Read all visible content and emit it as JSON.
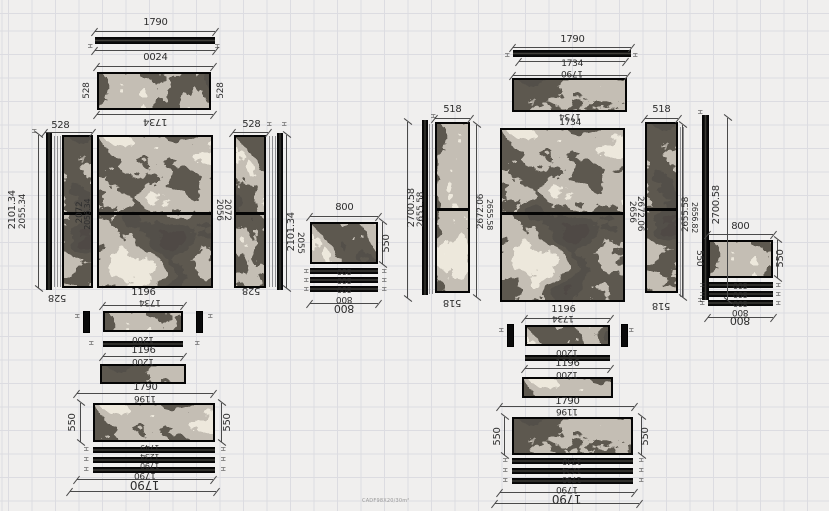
{
  "caption": "CADF98X20/30m²",
  "colors": {
    "background": "#f0efee",
    "grid_line": "#dcdce1",
    "dimension": "#4a4a4a",
    "dimension_text": "#2e2e2e",
    "panel_frame": "#050505",
    "marble_base": "#17130d",
    "marble_vein": "#d6cfc0"
  },
  "panels": [
    {
      "name": "left-top-528-panel",
      "x": 97,
      "y": 72,
      "w": 114,
      "h": 38,
      "tex": "B",
      "split": null
    },
    {
      "name": "left-side-panel-a",
      "x": 62,
      "y": 135,
      "w": 31,
      "h": 153,
      "tex": "C",
      "split": 0.5
    },
    {
      "name": "left-main-panel",
      "x": 97,
      "y": 135,
      "w": 116,
      "h": 153,
      "tex": "A",
      "split": 0.5
    },
    {
      "name": "left-side-panel-b",
      "x": 234,
      "y": 135,
      "w": 32,
      "h": 153,
      "tex": "D",
      "split": 0.5
    },
    {
      "name": "left-800-panel",
      "x": 310,
      "y": 222,
      "w": 68,
      "h": 42,
      "tex": "D",
      "split": null
    },
    {
      "name": "left-band-strip-a",
      "x": 103,
      "y": 311,
      "w": 80,
      "h": 21,
      "tex": "B",
      "split": null
    },
    {
      "name": "left-band-strip-b",
      "x": 100,
      "y": 364,
      "w": 86,
      "h": 20,
      "tex": "C",
      "split": null
    },
    {
      "name": "left-bottom-band",
      "x": 93,
      "y": 403,
      "w": 122,
      "h": 39,
      "tex": "A",
      "split": null
    },
    {
      "name": "right-top-518-panel",
      "x": 512,
      "y": 78,
      "w": 115,
      "h": 34,
      "tex": "C",
      "split": null
    },
    {
      "name": "right-side-panel-a",
      "x": 435,
      "y": 122,
      "w": 35,
      "h": 171,
      "tex": "B",
      "split": 0.5
    },
    {
      "name": "right-main-panel",
      "x": 500,
      "y": 128,
      "w": 125,
      "h": 174,
      "tex": "A",
      "split": 0.48
    },
    {
      "name": "right-side-panel-b",
      "x": 645,
      "y": 122,
      "w": 33,
      "h": 171,
      "tex": "C",
      "split": 0.5
    },
    {
      "name": "right-800-panel",
      "x": 708,
      "y": 240,
      "w": 65,
      "h": 38,
      "tex": "B",
      "split": null
    },
    {
      "name": "right-band-strip-a",
      "x": 525,
      "y": 325,
      "w": 85,
      "h": 21,
      "tex": "D",
      "split": null
    },
    {
      "name": "right-band-strip-b",
      "x": 522,
      "y": 377,
      "w": 91,
      "h": 21,
      "tex": "A",
      "split": null
    },
    {
      "name": "right-bottom-band",
      "x": 512,
      "y": 417,
      "w": 121,
      "h": 38,
      "tex": "C",
      "split": null
    }
  ],
  "edge_strips_h": [
    {
      "x": 95,
      "y": 37,
      "w": 120,
      "h": 7
    },
    {
      "x": 103,
      "y": 341,
      "w": 80,
      "h": 6
    },
    {
      "x": 93,
      "y": 447,
      "w": 122,
      "h": 6
    },
    {
      "x": 93,
      "y": 457,
      "w": 122,
      "h": 6
    },
    {
      "x": 93,
      "y": 467,
      "w": 122,
      "h": 6
    },
    {
      "x": 310,
      "y": 268,
      "w": 68,
      "h": 6
    },
    {
      "x": 310,
      "y": 277,
      "w": 68,
      "h": 6
    },
    {
      "x": 310,
      "y": 286,
      "w": 68,
      "h": 6
    },
    {
      "x": 513,
      "y": 50,
      "w": 118,
      "h": 7
    },
    {
      "x": 525,
      "y": 355,
      "w": 85,
      "h": 6
    },
    {
      "x": 512,
      "y": 458,
      "w": 121,
      "h": 6
    },
    {
      "x": 512,
      "y": 468,
      "w": 121,
      "h": 6
    },
    {
      "x": 512,
      "y": 478,
      "w": 121,
      "h": 6
    },
    {
      "x": 708,
      "y": 282,
      "w": 65,
      "h": 6
    },
    {
      "x": 708,
      "y": 291,
      "w": 65,
      "h": 6
    },
    {
      "x": 708,
      "y": 300,
      "w": 65,
      "h": 6
    }
  ],
  "edge_strips_v": [
    {
      "x": 46,
      "y": 133,
      "w": 6,
      "h": 157
    },
    {
      "x": 277,
      "y": 133,
      "w": 6,
      "h": 157
    },
    {
      "x": 422,
      "y": 120,
      "w": 6,
      "h": 175
    },
    {
      "x": 702,
      "y": 115,
      "w": 7,
      "h": 185
    }
  ],
  "hatch_lines": [
    {
      "x": 54,
      "y": 136,
      "w": 8,
      "h": 151
    },
    {
      "x": 269,
      "y": 136,
      "w": 7,
      "h": 151
    },
    {
      "x": 429,
      "y": 124,
      "w": 6,
      "h": 170
    },
    {
      "x": 680,
      "y": 127,
      "w": 5,
      "h": 170
    }
  ],
  "posts": [
    {
      "x": 83,
      "y": 311,
      "w": 7,
      "h": 22
    },
    {
      "x": 196,
      "y": 311,
      "w": 7,
      "h": 22
    },
    {
      "x": 507,
      "y": 324,
      "w": 7,
      "h": 23
    },
    {
      "x": 621,
      "y": 324,
      "w": 7,
      "h": 23
    }
  ],
  "dim_lines": [
    {
      "o": "h",
      "x": 95,
      "y": 31,
      "l": 120
    },
    {
      "o": "h",
      "x": 95,
      "y": 50,
      "l": 120
    },
    {
      "o": "h",
      "x": 97,
      "y": 66,
      "l": 116
    },
    {
      "o": "h",
      "x": 97,
      "y": 114,
      "l": 116
    },
    {
      "o": "h",
      "x": 45,
      "y": 132,
      "l": 47
    },
    {
      "o": "h",
      "x": 233,
      "y": 132,
      "l": 35
    },
    {
      "o": "v",
      "x": 38,
      "y": 135,
      "l": 153
    },
    {
      "o": "v",
      "x": 286,
      "y": 135,
      "l": 153
    },
    {
      "o": "h",
      "x": 310,
      "y": 216,
      "l": 68
    },
    {
      "o": "v",
      "x": 382,
      "y": 222,
      "l": 42
    },
    {
      "o": "h",
      "x": 310,
      "y": 303,
      "l": 68
    },
    {
      "o": "h",
      "x": 103,
      "y": 305,
      "l": 80
    },
    {
      "o": "h",
      "x": 103,
      "y": 356,
      "l": 80
    },
    {
      "o": "h",
      "x": 77,
      "y": 393,
      "l": 136
    },
    {
      "o": "v",
      "x": 80,
      "y": 403,
      "l": 39
    },
    {
      "o": "v",
      "x": 221,
      "y": 403,
      "l": 39
    },
    {
      "o": "h",
      "x": 77,
      "y": 479,
      "l": 136
    },
    {
      "o": "h",
      "x": 70,
      "y": 491,
      "l": 146
    },
    {
      "o": "h",
      "x": 513,
      "y": 47,
      "l": 118
    },
    {
      "o": "h",
      "x": 519,
      "y": 61,
      "l": 106
    },
    {
      "o": "h",
      "x": 513,
      "y": 75,
      "l": 114
    },
    {
      "o": "h",
      "x": 435,
      "y": 118,
      "l": 35
    },
    {
      "o": "h",
      "x": 645,
      "y": 118,
      "l": 33
    },
    {
      "o": "v",
      "x": 407,
      "y": 122,
      "l": 176
    },
    {
      "o": "v",
      "x": 476,
      "y": 125,
      "l": 172
    },
    {
      "o": "v",
      "x": 682,
      "y": 125,
      "l": 172
    },
    {
      "o": "v",
      "x": 727,
      "y": 118,
      "l": 182
    },
    {
      "o": "h",
      "x": 708,
      "y": 234,
      "l": 65
    },
    {
      "o": "v",
      "x": 777,
      "y": 240,
      "l": 38
    },
    {
      "o": "h",
      "x": 708,
      "y": 317,
      "l": 65
    },
    {
      "o": "h",
      "x": 525,
      "y": 318,
      "l": 85
    },
    {
      "o": "h",
      "x": 525,
      "y": 368,
      "l": 85
    },
    {
      "o": "h",
      "x": 500,
      "y": 406,
      "l": 134
    },
    {
      "o": "v",
      "x": 504,
      "y": 417,
      "l": 38
    },
    {
      "o": "v",
      "x": 641,
      "y": 417,
      "l": 38
    },
    {
      "o": "h",
      "x": 500,
      "y": 492,
      "l": 134
    },
    {
      "o": "h",
      "x": 495,
      "y": 503,
      "l": 144
    }
  ],
  "labels": [
    {
      "t": "1790",
      "x": 155,
      "y": 23,
      "s": 10,
      "o": ""
    },
    {
      "t": "0024",
      "x": 155,
      "y": 58,
      "s": 10,
      "o": ""
    },
    {
      "t": "528",
      "x": 87,
      "y": 90,
      "s": 9,
      "o": "v"
    },
    {
      "t": "528",
      "x": 221,
      "y": 90,
      "s": 9,
      "o": "v"
    },
    {
      "t": "1734",
      "x": 155,
      "y": 121,
      "s": 10,
      "o": "f"
    },
    {
      "t": "528",
      "x": 60,
      "y": 126,
      "s": 10,
      "o": ""
    },
    {
      "t": "528",
      "x": 251,
      "y": 125,
      "s": 10,
      "o": ""
    },
    {
      "t": "2101.34",
      "x": 13,
      "y": 210,
      "s": 10,
      "o": "v"
    },
    {
      "t": "2055.34",
      "x": 23,
      "y": 212,
      "s": 9,
      "o": "v"
    },
    {
      "t": "2072",
      "x": 80,
      "y": 212,
      "s": 9,
      "o": "v"
    },
    {
      "t": "2056.34",
      "x": 88,
      "y": 214,
      "s": 8,
      "o": "v"
    },
    {
      "t": "2056",
      "x": 218,
      "y": 210,
      "s": 9,
      "o": "vf"
    },
    {
      "t": "2072",
      "x": 226,
      "y": 210,
      "s": 9,
      "o": "vf"
    },
    {
      "t": "2101.34",
      "x": 292,
      "y": 232,
      "s": 10,
      "o": "v"
    },
    {
      "t": "2055",
      "x": 299,
      "y": 243,
      "s": 9,
      "o": "vf"
    },
    {
      "t": "528",
      "x": 57,
      "y": 297,
      "s": 10,
      "o": "f"
    },
    {
      "t": "528",
      "x": 251,
      "y": 290,
      "s": 10,
      "o": "f"
    },
    {
      "t": "800",
      "x": 344,
      "y": 208,
      "s": 10,
      "o": ""
    },
    {
      "t": "550",
      "x": 387,
      "y": 243,
      "s": 10,
      "o": "v"
    },
    {
      "t": "800",
      "x": 344,
      "y": 271,
      "s": 8,
      "o": "f"
    },
    {
      "t": "800",
      "x": 344,
      "y": 280,
      "s": 8,
      "o": "f"
    },
    {
      "t": "800",
      "x": 344,
      "y": 289,
      "s": 8,
      "o": "f"
    },
    {
      "t": "800",
      "x": 344,
      "y": 298,
      "s": 9,
      "o": "f"
    },
    {
      "t": "800",
      "x": 344,
      "y": 308,
      "s": 11,
      "o": "f"
    },
    {
      "t": "1196",
      "x": 143,
      "y": 293,
      "s": 10,
      "o": ""
    },
    {
      "t": "1734",
      "x": 150,
      "y": 301,
      "s": 9,
      "o": "f"
    },
    {
      "t": "1200",
      "x": 143,
      "y": 338,
      "s": 9,
      "o": "f"
    },
    {
      "t": "1196",
      "x": 143,
      "y": 351,
      "s": 10,
      "o": ""
    },
    {
      "t": "1200",
      "x": 143,
      "y": 360,
      "s": 9,
      "o": "f"
    },
    {
      "t": "1790",
      "x": 145,
      "y": 388,
      "s": 10,
      "o": ""
    },
    {
      "t": "1196",
      "x": 145,
      "y": 397,
      "s": 9,
      "o": "f"
    },
    {
      "t": "550",
      "x": 73,
      "y": 422,
      "s": 10,
      "o": "v"
    },
    {
      "t": "550",
      "x": 228,
      "y": 422,
      "s": 10,
      "o": "v"
    },
    {
      "t": "1749",
      "x": 150,
      "y": 447,
      "s": 8,
      "o": "f"
    },
    {
      "t": "1234",
      "x": 150,
      "y": 456,
      "s": 8,
      "o": "f"
    },
    {
      "t": "1790",
      "x": 150,
      "y": 465,
      "s": 8,
      "o": "f"
    },
    {
      "t": "1790",
      "x": 145,
      "y": 474,
      "s": 9,
      "o": "f"
    },
    {
      "t": "1790",
      "x": 145,
      "y": 485,
      "s": 12,
      "o": "f"
    },
    {
      "t": "1790",
      "x": 572,
      "y": 40,
      "s": 10,
      "o": ""
    },
    {
      "t": "1734",
      "x": 572,
      "y": 64,
      "s": 9,
      "o": ""
    },
    {
      "t": "1790",
      "x": 572,
      "y": 72,
      "s": 9,
      "o": "f"
    },
    {
      "t": "1734",
      "x": 570,
      "y": 115,
      "s": 9,
      "o": "f"
    },
    {
      "t": "1734",
      "x": 570,
      "y": 123,
      "s": 9,
      "o": ""
    },
    {
      "t": "518",
      "x": 452,
      "y": 110,
      "s": 10,
      "o": ""
    },
    {
      "t": "518",
      "x": 661,
      "y": 110,
      "s": 10,
      "o": ""
    },
    {
      "t": "2700.58",
      "x": 412,
      "y": 208,
      "s": 10,
      "o": "v"
    },
    {
      "t": "2655.58",
      "x": 421,
      "y": 210,
      "s": 9,
      "o": "v"
    },
    {
      "t": "2672.06",
      "x": 481,
      "y": 212,
      "s": 9,
      "o": "v"
    },
    {
      "t": "2655.58",
      "x": 489,
      "y": 214,
      "s": 8,
      "o": "vf"
    },
    {
      "t": "2656",
      "x": 631,
      "y": 212,
      "s": 9,
      "o": "vf"
    },
    {
      "t": "2672.06",
      "x": 639,
      "y": 214,
      "s": 9,
      "o": "vf"
    },
    {
      "t": "2655.58",
      "x": 686,
      "y": 215,
      "s": 9,
      "o": "v"
    },
    {
      "t": "2656.82",
      "x": 694,
      "y": 217,
      "s": 8,
      "o": "vf"
    },
    {
      "t": "518",
      "x": 452,
      "y": 302,
      "s": 10,
      "o": "f"
    },
    {
      "t": "518",
      "x": 661,
      "y": 305,
      "s": 10,
      "o": "f"
    },
    {
      "t": "2700.58",
      "x": 717,
      "y": 205,
      "s": 10,
      "o": "v"
    },
    {
      "t": "550",
      "x": 698,
      "y": 258,
      "s": 9,
      "o": "vf"
    },
    {
      "t": "800",
      "x": 740,
      "y": 227,
      "s": 10,
      "o": ""
    },
    {
      "t": "550",
      "x": 781,
      "y": 258,
      "s": 10,
      "o": "v"
    },
    {
      "t": "800",
      "x": 740,
      "y": 285,
      "s": 8,
      "o": "f"
    },
    {
      "t": "800",
      "x": 740,
      "y": 294,
      "s": 8,
      "o": "f"
    },
    {
      "t": "800",
      "x": 740,
      "y": 303,
      "s": 8,
      "o": "f"
    },
    {
      "t": "800",
      "x": 740,
      "y": 311,
      "s": 9,
      "o": "f"
    },
    {
      "t": "800",
      "x": 740,
      "y": 320,
      "s": 11,
      "o": "f"
    },
    {
      "t": "1196",
      "x": 563,
      "y": 310,
      "s": 10,
      "o": ""
    },
    {
      "t": "1734",
      "x": 563,
      "y": 317,
      "s": 9,
      "o": "f"
    },
    {
      "t": "1200",
      "x": 567,
      "y": 351,
      "s": 9,
      "o": "f"
    },
    {
      "t": "1196",
      "x": 567,
      "y": 364,
      "s": 10,
      "o": ""
    },
    {
      "t": "1200",
      "x": 567,
      "y": 373,
      "s": 9,
      "o": "f"
    },
    {
      "t": "1790",
      "x": 567,
      "y": 402,
      "s": 10,
      "o": ""
    },
    {
      "t": "1196",
      "x": 567,
      "y": 410,
      "s": 9,
      "o": "f"
    },
    {
      "t": "550",
      "x": 498,
      "y": 436,
      "s": 10,
      "o": "v"
    },
    {
      "t": "550",
      "x": 646,
      "y": 436,
      "s": 10,
      "o": "v"
    },
    {
      "t": "1749",
      "x": 572,
      "y": 461,
      "s": 8,
      "o": "f"
    },
    {
      "t": "1234",
      "x": 572,
      "y": 470,
      "s": 8,
      "o": "f"
    },
    {
      "t": "1790",
      "x": 572,
      "y": 479,
      "s": 8,
      "o": "f"
    },
    {
      "t": "1790",
      "x": 567,
      "y": 488,
      "s": 9,
      "o": "f"
    },
    {
      "t": "1790",
      "x": 567,
      "y": 499,
      "s": 12,
      "o": "f"
    }
  ],
  "tick_marks": [
    {
      "x": 89,
      "y": 46
    },
    {
      "x": 216,
      "y": 46
    },
    {
      "x": 33,
      "y": 131
    },
    {
      "x": 268,
      "y": 124
    },
    {
      "x": 283,
      "y": 124
    },
    {
      "x": 76,
      "y": 316
    },
    {
      "x": 209,
      "y": 316
    },
    {
      "x": 90,
      "y": 343
    },
    {
      "x": 196,
      "y": 343
    },
    {
      "x": 85,
      "y": 449
    },
    {
      "x": 222,
      "y": 449
    },
    {
      "x": 85,
      "y": 459
    },
    {
      "x": 222,
      "y": 459
    },
    {
      "x": 85,
      "y": 469
    },
    {
      "x": 222,
      "y": 469
    },
    {
      "x": 305,
      "y": 271
    },
    {
      "x": 383,
      "y": 271
    },
    {
      "x": 305,
      "y": 280
    },
    {
      "x": 383,
      "y": 280
    },
    {
      "x": 305,
      "y": 289
    },
    {
      "x": 383,
      "y": 289
    },
    {
      "x": 506,
      "y": 55
    },
    {
      "x": 634,
      "y": 55
    },
    {
      "x": 432,
      "y": 116
    },
    {
      "x": 699,
      "y": 112
    },
    {
      "x": 699,
      "y": 300
    },
    {
      "x": 500,
      "y": 330
    },
    {
      "x": 630,
      "y": 330
    },
    {
      "x": 701,
      "y": 285
    },
    {
      "x": 777,
      "y": 285
    },
    {
      "x": 701,
      "y": 294
    },
    {
      "x": 777,
      "y": 294
    },
    {
      "x": 701,
      "y": 303
    },
    {
      "x": 777,
      "y": 303
    },
    {
      "x": 504,
      "y": 460
    },
    {
      "x": 640,
      "y": 460
    },
    {
      "x": 504,
      "y": 470
    },
    {
      "x": 640,
      "y": 470
    },
    {
      "x": 504,
      "y": 480
    },
    {
      "x": 640,
      "y": 480
    }
  ]
}
